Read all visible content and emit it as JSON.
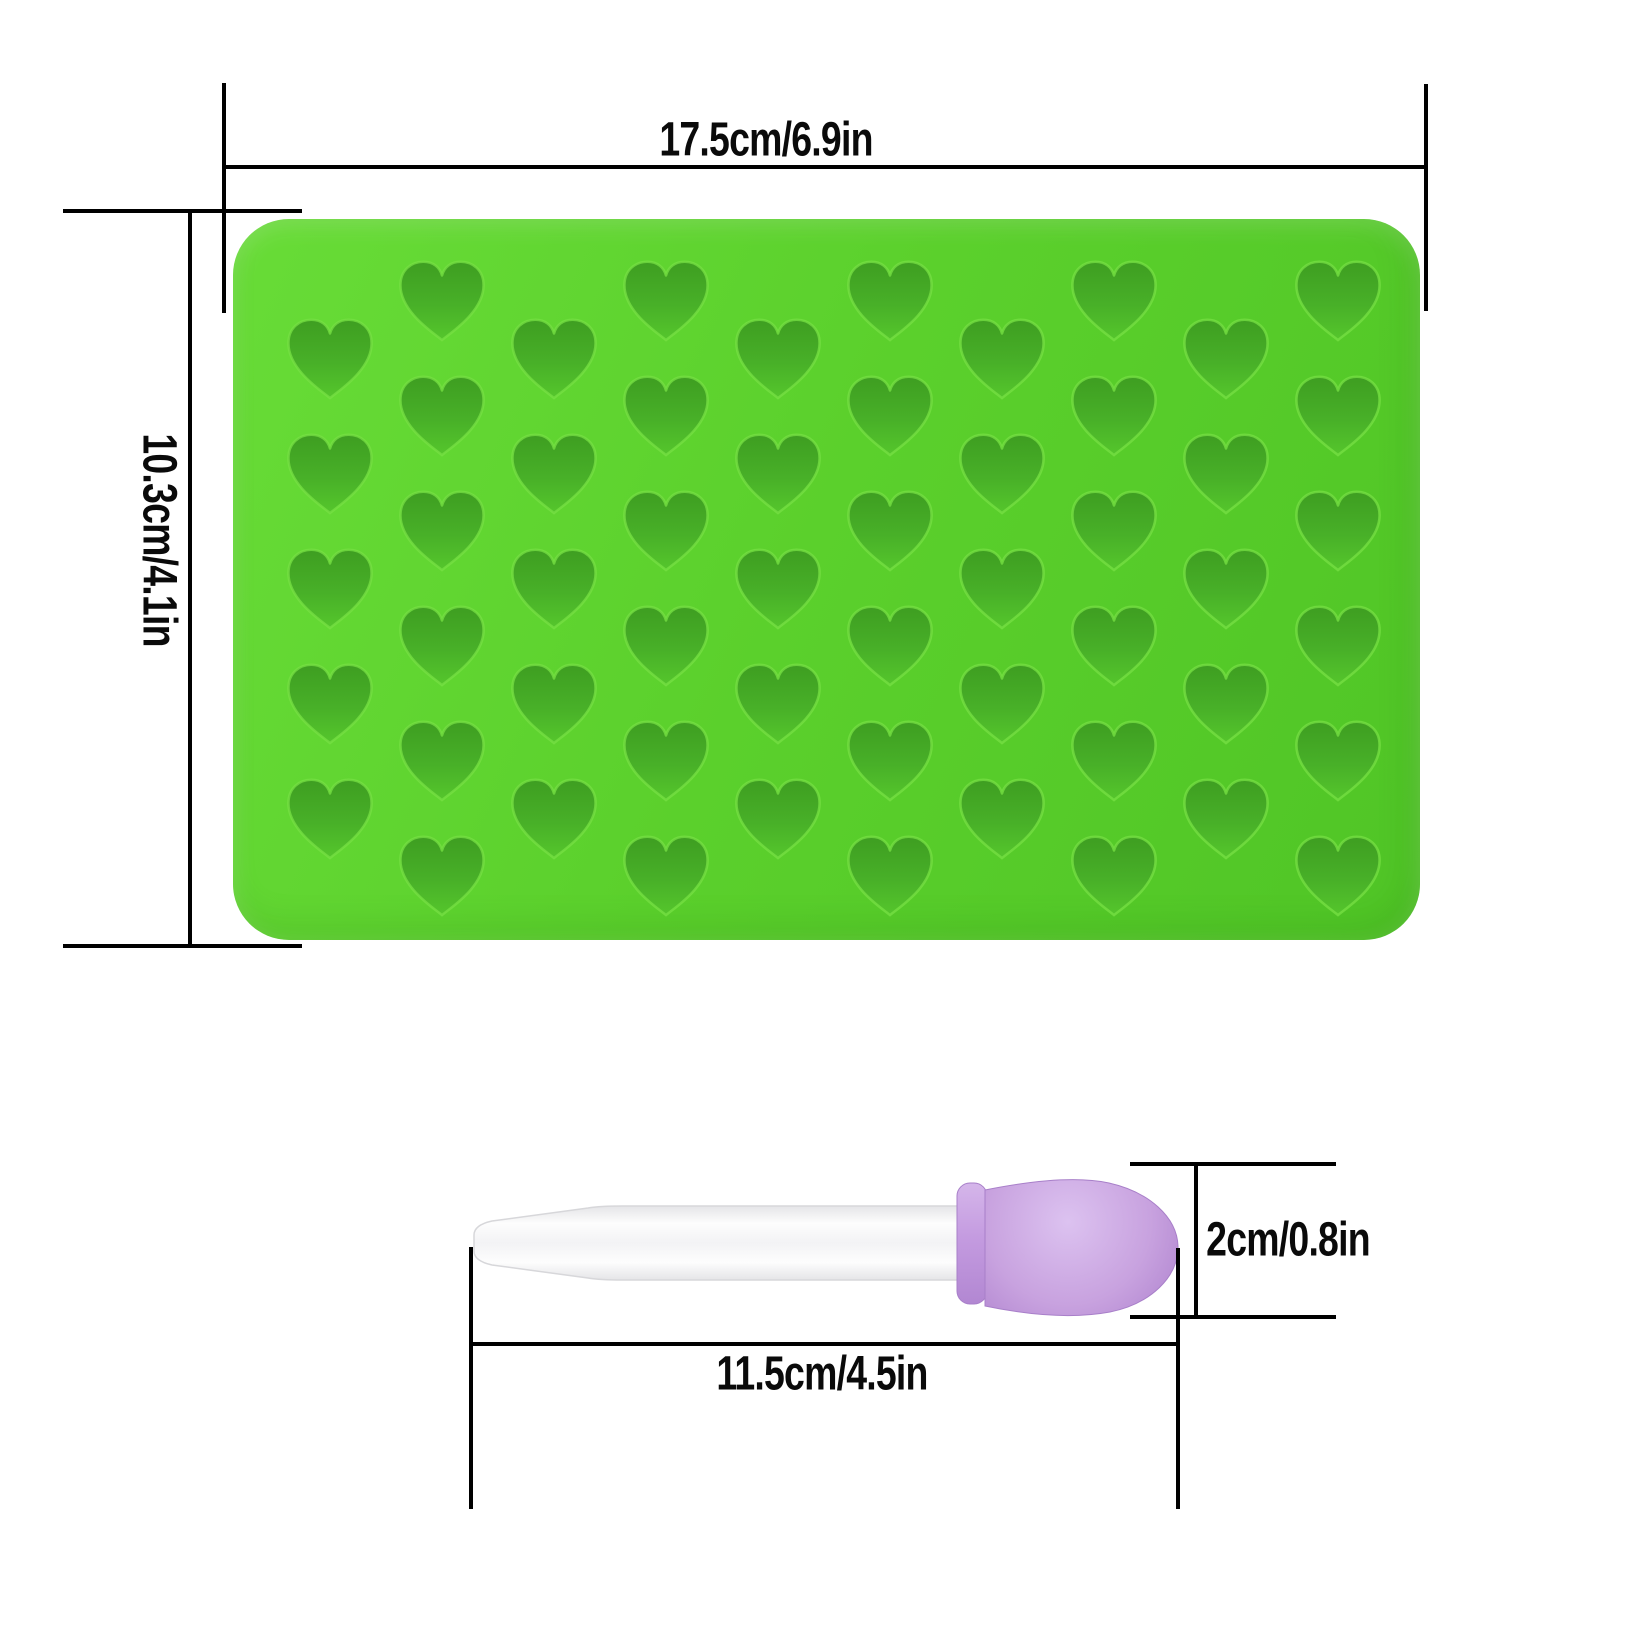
{
  "page": {
    "background": "#ffffff",
    "line_color": "#000000"
  },
  "annotations": {
    "mold_width": {
      "label": "17.5cm/6.9in"
    },
    "mold_height": {
      "label": "10.3cm/4.1in"
    },
    "dropper_length": {
      "label": "11.5cm/4.5in"
    },
    "dropper_bulb_height": {
      "label": "2cm/0.8in"
    }
  },
  "colors": {
    "mold_light": "#68dc37",
    "mold_surface": "#5bd02c",
    "mold_dark": "#50c526",
    "cavity_top": "#3e9e21",
    "cavity_mid": "#48b028",
    "cavity_bottom": "#55c62c",
    "cavity_rim": "#77e044",
    "tube_edge": "#e2e2e5",
    "tube_light": "#fdfdfd",
    "tube_mid": "#f3f3f5",
    "bulb_light": "#dcc2f0",
    "bulb_mid": "#c8a2df",
    "bulb_dark": "#ab7ecc",
    "collar_light": "#d5b6ea",
    "collar_mid": "#c49be0",
    "collar_dark": "#b287d2"
  },
  "css_vars": {
    "--page-bg": "#ffffff",
    "--mold-light": "#68dc37",
    "--mold-surface": "#5bd02c",
    "--mold-dark": "#50c526"
  },
  "mold": {
    "cavity_shape": "heart",
    "cavity_total": 55,
    "heart_width": 104,
    "heart_height": 98,
    "row_spacing": 115,
    "origin": {
      "x": 233,
      "y": 219
    },
    "heart_columns": [
      {
        "x": 330,
        "first_y": 358,
        "count": 5
      },
      {
        "x": 442,
        "first_y": 300,
        "count": 6
      },
      {
        "x": 554,
        "first_y": 358,
        "count": 5
      },
      {
        "x": 666,
        "first_y": 300,
        "count": 6
      },
      {
        "x": 778,
        "first_y": 358,
        "count": 5
      },
      {
        "x": 890,
        "first_y": 300,
        "count": 6
      },
      {
        "x": 1002,
        "first_y": 358,
        "count": 5
      },
      {
        "x": 1114,
        "first_y": 300,
        "count": 6
      },
      {
        "x": 1226,
        "first_y": 358,
        "count": 5
      },
      {
        "x": 1338,
        "first_y": 300,
        "count": 6
      }
    ]
  }
}
